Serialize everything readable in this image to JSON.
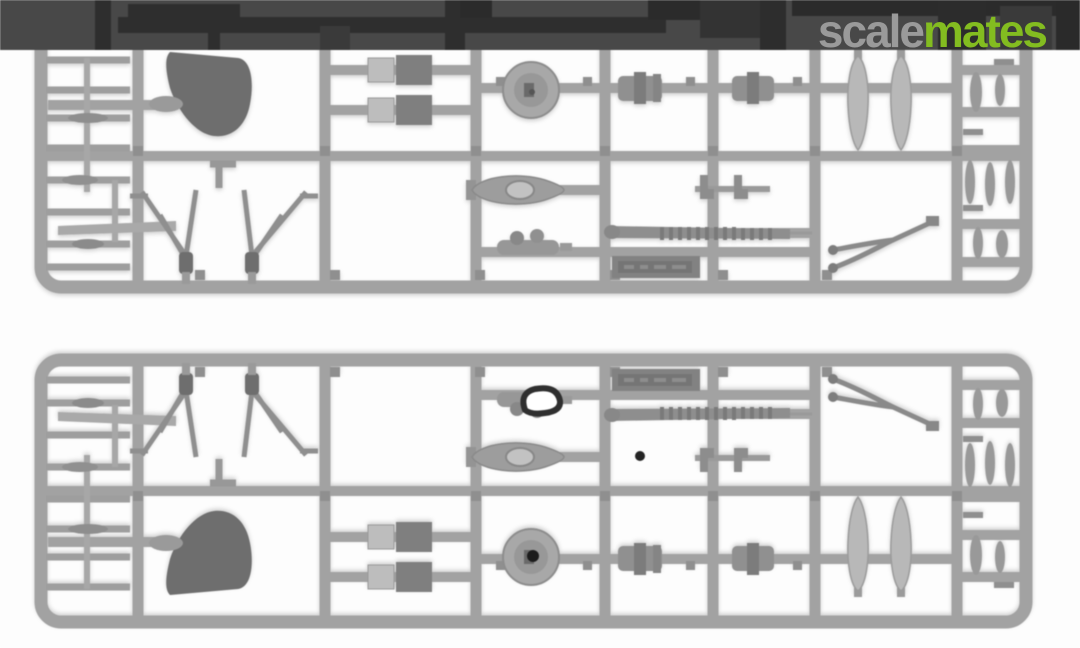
{
  "header": {
    "watermark": {
      "part1": "scale",
      "part2": "mates"
    }
  },
  "photo": {
    "subject": "Two grey injection-moulded plastic model-kit sprues with small aircraft parts (propeller blades, radial engine discs, cowling, struts, cylinders) on a white background",
    "sprues": [
      {
        "id": "sprue-top",
        "orientation": "face-up, top edge hidden under header strip"
      },
      {
        "id": "sprue-bottom",
        "orientation": "same sprue flipped vertically, cut off at bottom edge"
      }
    ]
  },
  "colors": {
    "background": "#fdfdfd",
    "bar": "#484848",
    "silhouette": "#2e2e2e",
    "logo_gray": "#9a9a9a",
    "logo_green": "#83bc20",
    "plastic": "#a2a2a2",
    "plastic_mid": "#949494",
    "plastic_dark": "#6e6e6e",
    "accent_dark": "#2f2f2f"
  }
}
